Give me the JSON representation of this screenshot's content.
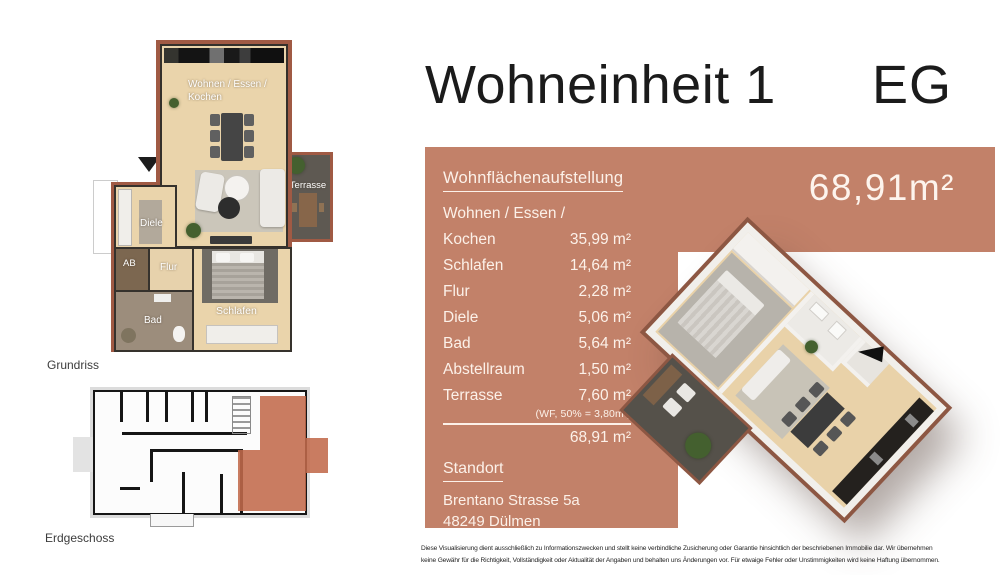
{
  "header": {
    "title": "Wohneinheit 1",
    "floor": "EG"
  },
  "area_panel": {
    "accent_color": "#c28169",
    "big_area": "68,91m²",
    "heading": "Wohnflächenaufstellung",
    "rows": [
      {
        "label": "Wohnen / Essen /",
        "value": ""
      },
      {
        "label": "Kochen",
        "value": "35,99 m²"
      },
      {
        "label": "Schlafen",
        "value": "14,64 m²"
      },
      {
        "label": "Flur",
        "value": "2,28 m²"
      },
      {
        "label": "Diele",
        "value": "5,06 m²"
      },
      {
        "label": "Bad",
        "value": "5,64 m²"
      },
      {
        "label": "Abstellraum",
        "value": "1,50 m²"
      },
      {
        "label": "Terrasse",
        "value": "7,60 m²"
      }
    ],
    "terrace_note": "(WF, 50% = 3,80m²)",
    "total": "68,91 m²",
    "location_heading": "Standort",
    "address": {
      "line1": "Brentano Strasse 5a",
      "line2": "48249 Dülmen"
    }
  },
  "plan2d": {
    "caption": "Grundriss",
    "labels": {
      "living1": "Wohnen / Essen /",
      "living2": "Kochen",
      "terrasse": "Terrasse",
      "diele": "Diele",
      "ab": "AB",
      "flur": "Flur",
      "bad": "Bad",
      "schlafen": "Schlafen"
    }
  },
  "schematic": {
    "caption": "Erdgeschoss",
    "highlight_color": "#c16a4b"
  },
  "disclaimer": {
    "line1": "Diese Visualisierung dient ausschließlich zu Informationszwecken und stellt keine verbindliche Zusicherung oder Garantie hinsichtlich der beschriebenen Immobilie dar.  Wir übernehmen",
    "line2": "keine Gewähr für die Richtigkeit, Vollständigkeit oder Aktualität der Angaben und behalten uns Änderungen vor. Für etwaige Fehler oder Unstimmigkeiten wird keine Haftung übernommen."
  }
}
